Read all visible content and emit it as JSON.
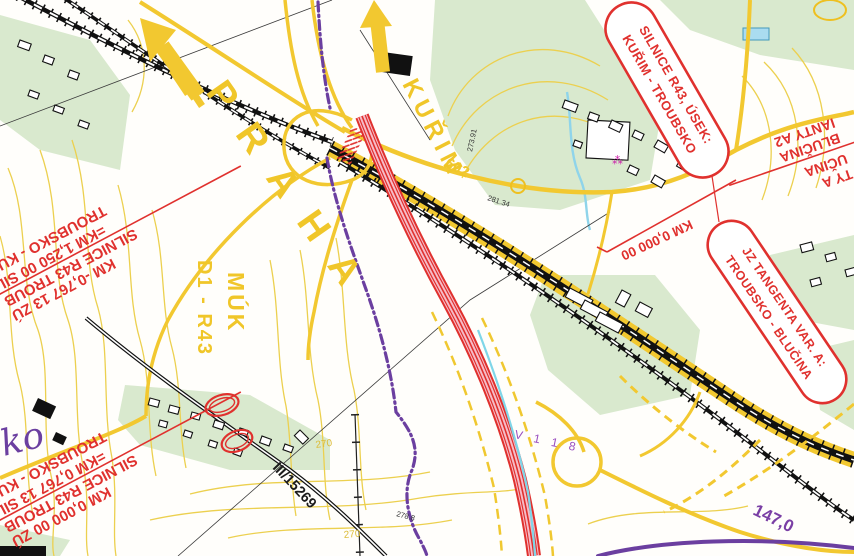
{
  "map_annotations": {
    "callout_r43_section": {
      "line1": "SILNICE R43, ÚSEK:",
      "line2": "KUŘIM - TROUBSKO"
    },
    "callout_jz_tangent": {
      "line1": "JZ TANGENTA VAR. A:",
      "line2": "TROUBSKO - BLUČINA"
    },
    "km_marker_start": "KM 0,000 00",
    "chainage_block_upper_left": {
      "row1": "KM -0,767 13 ZÚ",
      "row2": "SILNICE R43 TROUB",
      "row3": "=KM 1,250 00 SIL",
      "row4": "TROUBSKO - KUŘ"
    },
    "chainage_block_lower_left": {
      "row1": "KM 0,000 00 ZÚ",
      "row2": "SILNICE R43 TROUB",
      "row3": "=KM 0,767 13 SIL",
      "row4": "TROUBSKO - KUŘ"
    },
    "chainage_block_right_edge": {
      "row1": "TY A",
      "row2": "UČINA",
      "row3": "BLUČINA",
      "row4": "IANTY A2"
    }
  },
  "direction_arrows": {
    "praha": "PRAHA",
    "kurim": "KUŘIM"
  },
  "road_labels": {
    "interchange_abbr": "MÚK",
    "interchange_roads": "D1 - R43",
    "route_602": "602",
    "route_iii_15269": "III/15269"
  },
  "map_labels": {
    "place_fragment": "ko",
    "d1_km_marker": "147,0",
    "cadastre_code": "V 1 1 8",
    "contour_270_a": "270",
    "contour_270_b": "270",
    "spot_height_a": "281.34",
    "spot_height_b": "273.91",
    "spot_height_c": "278.8"
  },
  "colors": {
    "annotation_red": "#e0312e",
    "road_yellow": "#f2c830",
    "contour_yellow": "#ecd04f",
    "planned_pink": "#f6bcc8",
    "boundary_purple": "#6b3fa0",
    "vegetation_green": "#d9e9ce",
    "water_blue": "#8fd4ea"
  }
}
